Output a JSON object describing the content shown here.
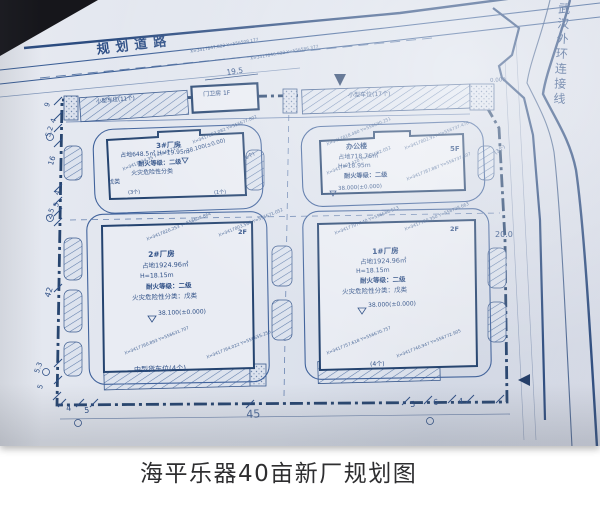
{
  "caption": "海平乐器40亩新厂规划图",
  "colors": {
    "ink": "#35568c",
    "ink_dark": "#24436f",
    "paper": "#e2e6ee"
  },
  "roads": {
    "top": "规划道路",
    "right": "武汉外环连接线"
  },
  "parking": {
    "small_11": "小型车位(11个)",
    "small_17": "小型车位(17个)",
    "truck_4": "中型货车位(4个)",
    "count_4": "(4个)",
    "count_3": "(3个)",
    "count_1": "(1个)",
    "count_6": "(6个)",
    "count_3b": "(3个)"
  },
  "guard_house": {
    "label": "门卫房 1F"
  },
  "buildings": {
    "b3": {
      "name": "3#厂房",
      "area": "占地648.5㎡ H=19.95m",
      "fire": "耐火等级：二级",
      "hazard": "火灾危险性分类",
      "hazard_class": "戊类",
      "level": "38.100(±0.00)"
    },
    "office": {
      "name": "办公楼",
      "area": "占地718.76㎡",
      "height": "H=18.95m",
      "fire": "耐火等级：二级",
      "level": "38.000(±0.000)",
      "floors": "5F"
    },
    "b2": {
      "name": "2#厂房",
      "area": "占地1924.96㎡",
      "height": "H=18.15m",
      "fire": "耐火等级：二级",
      "hazard": "火灾危险性分类：戊类",
      "level": "38.100(±0.000)",
      "floors": "2F"
    },
    "b1": {
      "name": "1#厂房",
      "area": "占地1924.96㎡",
      "height": "H=18.15m",
      "fire": "耐火等级：二级",
      "hazard": "火灾危险性分类：戊类",
      "level": "38.000(±0.000)",
      "floors": "2F"
    }
  },
  "dims": {
    "left": [
      "9",
      "4",
      "5.2",
      "16",
      "4",
      "5",
      "2.5",
      "42",
      "5.3",
      "5"
    ],
    "bottom": [
      "4",
      "5",
      "45",
      "5",
      "6",
      "4"
    ],
    "top": "19.5",
    "right": "20.0",
    "datum": "0.000"
  },
  "survey_points": [
    "X=3417847.822 Y=556508.177",
    "X=3417846.022 Y=556586.377",
    "X=3417853.082 Y=556677.802",
    "X=3417814.35 Y=556671.52",
    "X=3417818.480 Y=556690.251",
    "X=3417802.927 Y=556737.478",
    "X=3417803.420 Y=556682.052",
    "X=3417787.887 Y=556737.407",
    "X=3417820.253 Y=556628.864",
    "X=3417803.566 Y=556671.052",
    "X=3417760.893 Y=556631.707",
    "X=3417764.022 Y=556655.256",
    "X=3417797.140 Y=556686.513",
    "X=3417780.350 Y=556728.663",
    "X=3417757.618 Y=556670.757",
    "X=3417740.947 Y=556772.905"
  ]
}
